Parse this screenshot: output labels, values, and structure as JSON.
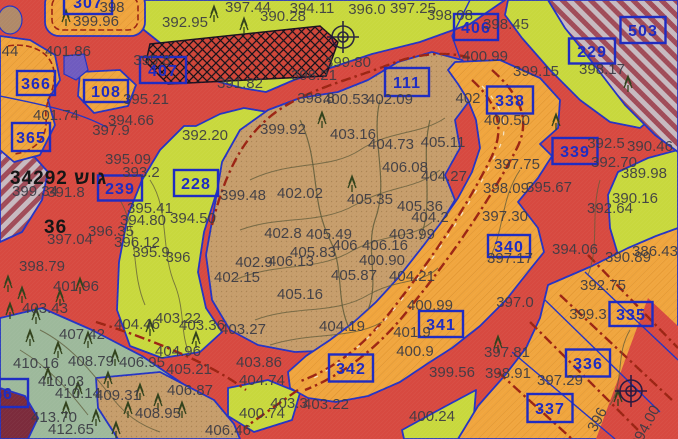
{
  "map": {
    "title_block": {
      "label": "34292 גוש",
      "secondary": "36"
    },
    "parcel_boxes": [
      {
        "n": "307",
        "x": 88,
        "y": 2,
        "w": 48,
        "h": 24
      },
      {
        "n": "406",
        "x": 476,
        "y": 27,
        "w": 44,
        "h": 26
      },
      {
        "n": "503",
        "x": 643,
        "y": 30,
        "w": 45,
        "h": 26
      },
      {
        "n": "229",
        "x": 592,
        "y": 51,
        "w": 46,
        "h": 25
      },
      {
        "n": "407",
        "x": 163,
        "y": 70,
        "w": 46,
        "h": 26
      },
      {
        "n": "111",
        "x": 407,
        "y": 82,
        "w": 44,
        "h": 28
      },
      {
        "n": "338",
        "x": 510,
        "y": 100,
        "w": 46,
        "h": 27
      },
      {
        "n": "366",
        "x": 36,
        "y": 83,
        "w": 38,
        "h": 24
      },
      {
        "n": "108",
        "x": 106,
        "y": 91,
        "w": 44,
        "h": 22
      },
      {
        "n": "365",
        "x": 31,
        "y": 137,
        "w": 38,
        "h": 28
      },
      {
        "n": "239",
        "x": 120,
        "y": 188,
        "w": 44,
        "h": 25
      },
      {
        "n": "228",
        "x": 196,
        "y": 183,
        "w": 44,
        "h": 26
      },
      {
        "n": "339",
        "x": 575,
        "y": 151,
        "w": 45,
        "h": 26
      },
      {
        "n": "340",
        "x": 509,
        "y": 246,
        "w": 42,
        "h": 22
      },
      {
        "n": "341",
        "x": 441,
        "y": 324,
        "w": 44,
        "h": 26
      },
      {
        "n": "342",
        "x": 351,
        "y": 368,
        "w": 44,
        "h": 27
      },
      {
        "n": "335",
        "x": 631,
        "y": 314,
        "w": 43,
        "h": 24
      },
      {
        "n": "336",
        "x": 588,
        "y": 363,
        "w": 44,
        "h": 27
      },
      {
        "n": "337",
        "x": 550,
        "y": 408,
        "w": 45,
        "h": 28
      },
      {
        "n": "56",
        "x": 3,
        "y": 393,
        "w": 50,
        "h": 28
      }
    ],
    "elevation_labels": [
      {
        "t": "398",
        "x": 112,
        "y": 8
      },
      {
        "t": "399.96",
        "x": 96,
        "y": 22
      },
      {
        "t": "392.95",
        "x": 185,
        "y": 23
      },
      {
        "t": "397.44",
        "x": 248,
        "y": 8
      },
      {
        "t": "390.28",
        "x": 283,
        "y": 17
      },
      {
        "t": "394.11",
        "x": 312,
        "y": 9
      },
      {
        "t": "396.0",
        "x": 367,
        "y": 10
      },
      {
        "t": "397.25",
        "x": 413,
        "y": 9
      },
      {
        "t": "398.08",
        "x": 450,
        "y": 16
      },
      {
        "t": "398.45",
        "x": 506,
        "y": 25
      },
      {
        "t": "400.99",
        "x": 485,
        "y": 57
      },
      {
        "t": "399.15",
        "x": 536,
        "y": 72
      },
      {
        "t": "398.17",
        "x": 602,
        "y": 70
      },
      {
        "t": "392.5",
        "x": 606,
        "y": 144
      },
      {
        "t": "390.46",
        "x": 650,
        "y": 147
      },
      {
        "t": "392.70",
        "x": 614,
        "y": 163
      },
      {
        "t": "389.98",
        "x": 644,
        "y": 174
      },
      {
        "t": "390.16",
        "x": 635,
        "y": 199
      },
      {
        "t": "392.64",
        "x": 610,
        "y": 209
      },
      {
        "t": "386.43",
        "x": 655,
        "y": 252
      },
      {
        "t": "394.06",
        "x": 575,
        "y": 250
      },
      {
        "t": "390.89",
        "x": 628,
        "y": 258
      },
      {
        "t": "44",
        "x": 10,
        "y": 52
      },
      {
        "t": "401.86",
        "x": 68,
        "y": 52
      },
      {
        "t": "395.8",
        "x": 152,
        "y": 61
      },
      {
        "t": "395.21",
        "x": 146,
        "y": 100
      },
      {
        "t": "394.66",
        "x": 131,
        "y": 121
      },
      {
        "t": "397.9",
        "x": 111,
        "y": 131
      },
      {
        "t": "392.20",
        "x": 205,
        "y": 136
      },
      {
        "t": "401.74",
        "x": 56,
        "y": 116
      },
      {
        "t": "391.82",
        "x": 240,
        "y": 84
      },
      {
        "t": "398.21",
        "x": 314,
        "y": 76
      },
      {
        "t": "399.80",
        "x": 348,
        "y": 63
      },
      {
        "t": "398.8",
        "x": 316,
        "y": 99
      },
      {
        "t": "400.53",
        "x": 346,
        "y": 100
      },
      {
        "t": "402.09",
        "x": 390,
        "y": 100
      },
      {
        "t": "399.92",
        "x": 283,
        "y": 130
      },
      {
        "t": "403.16",
        "x": 353,
        "y": 135
      },
      {
        "t": "404.73",
        "x": 391,
        "y": 145
      },
      {
        "t": "405.11",
        "x": 443,
        "y": 143
      },
      {
        "t": "406.08",
        "x": 405,
        "y": 168
      },
      {
        "t": "404.27",
        "x": 444,
        "y": 177
      },
      {
        "t": "405.36",
        "x": 420,
        "y": 207
      },
      {
        "t": "404.2",
        "x": 430,
        "y": 218
      },
      {
        "t": "399.48",
        "x": 243,
        "y": 196
      },
      {
        "t": "402.02",
        "x": 300,
        "y": 194
      },
      {
        "t": "405.35",
        "x": 370,
        "y": 200
      },
      {
        "t": "402.8",
        "x": 283,
        "y": 234
      },
      {
        "t": "405.49",
        "x": 329,
        "y": 235
      },
      {
        "t": "403.99",
        "x": 412,
        "y": 235
      },
      {
        "t": "406",
        "x": 345,
        "y": 246
      },
      {
        "t": "406.16",
        "x": 385,
        "y": 246
      },
      {
        "t": "405.83",
        "x": 313,
        "y": 253
      },
      {
        "t": "400.90",
        "x": 382,
        "y": 261
      },
      {
        "t": "402.9",
        "x": 254,
        "y": 263
      },
      {
        "t": "406.13",
        "x": 291,
        "y": 262
      },
      {
        "t": "402.15",
        "x": 237,
        "y": 278
      },
      {
        "t": "405.87",
        "x": 354,
        "y": 276
      },
      {
        "t": "404.21",
        "x": 412,
        "y": 277
      },
      {
        "t": "405.16",
        "x": 300,
        "y": 295
      },
      {
        "t": "404.19",
        "x": 342,
        "y": 327
      },
      {
        "t": "403.27",
        "x": 243,
        "y": 330
      },
      {
        "t": "399.34",
        "x": 35,
        "y": 192
      },
      {
        "t": "391.8",
        "x": 66,
        "y": 193
      },
      {
        "t": "395.09",
        "x": 128,
        "y": 160
      },
      {
        "t": "393.2",
        "x": 141,
        "y": 173
      },
      {
        "t": "395.41",
        "x": 150,
        "y": 209
      },
      {
        "t": "394.80",
        "x": 143,
        "y": 221
      },
      {
        "t": "394.50",
        "x": 193,
        "y": 219
      },
      {
        "t": "396.35",
        "x": 111,
        "y": 232
      },
      {
        "t": "397.04",
        "x": 70,
        "y": 240
      },
      {
        "t": "396.12",
        "x": 137,
        "y": 243
      },
      {
        "t": "395.9",
        "x": 151,
        "y": 253
      },
      {
        "t": "396",
        "x": 178,
        "y": 258
      },
      {
        "t": "398.79",
        "x": 42,
        "y": 267
      },
      {
        "t": "401.96",
        "x": 76,
        "y": 287
      },
      {
        "t": "403.43",
        "x": 45,
        "y": 309
      },
      {
        "t": "407.42",
        "x": 82,
        "y": 335
      },
      {
        "t": "404.46",
        "x": 137,
        "y": 325
      },
      {
        "t": "403.22",
        "x": 178,
        "y": 319
      },
      {
        "t": "403.36",
        "x": 202,
        "y": 326
      },
      {
        "t": "404.96",
        "x": 178,
        "y": 352
      },
      {
        "t": "408.79",
        "x": 91,
        "y": 362
      },
      {
        "t": "406.95",
        "x": 142,
        "y": 363
      },
      {
        "t": "405.21",
        "x": 189,
        "y": 370
      },
      {
        "t": "410.16",
        "x": 36,
        "y": 364
      },
      {
        "t": "410.03",
        "x": 61,
        "y": 382
      },
      {
        "t": "410.14",
        "x": 78,
        "y": 394
      },
      {
        "t": "409.31",
        "x": 118,
        "y": 396
      },
      {
        "t": "413.70",
        "x": 54,
        "y": 418
      },
      {
        "t": "412.65",
        "x": 71,
        "y": 430
      },
      {
        "t": "406.87",
        "x": 190,
        "y": 391
      },
      {
        "t": "408.95",
        "x": 158,
        "y": 414
      },
      {
        "t": "403.86",
        "x": 259,
        "y": 363
      },
      {
        "t": "404.74",
        "x": 262,
        "y": 381
      },
      {
        "t": "403.3",
        "x": 289,
        "y": 404
      },
      {
        "t": "403.22",
        "x": 326,
        "y": 405
      },
      {
        "t": "400.74",
        "x": 262,
        "y": 414
      },
      {
        "t": "406.46",
        "x": 228,
        "y": 431
      },
      {
        "t": "400.24",
        "x": 432,
        "y": 417
      },
      {
        "t": "399.56",
        "x": 452,
        "y": 373
      },
      {
        "t": "398.91",
        "x": 508,
        "y": 374
      },
      {
        "t": "397.29",
        "x": 560,
        "y": 381
      },
      {
        "t": "397.81",
        "x": 507,
        "y": 353
      },
      {
        "t": "397.0",
        "x": 515,
        "y": 303
      },
      {
        "t": "397.17",
        "x": 510,
        "y": 259
      },
      {
        "t": "400.99",
        "x": 430,
        "y": 306
      },
      {
        "t": "401.9",
        "x": 412,
        "y": 333
      },
      {
        "t": "400.9",
        "x": 415,
        "y": 352
      },
      {
        "t": "397.75",
        "x": 517,
        "y": 165
      },
      {
        "t": "398.09",
        "x": 506,
        "y": 189
      },
      {
        "t": "395.67",
        "x": 549,
        "y": 188
      },
      {
        "t": "397.30",
        "x": 505,
        "y": 217
      },
      {
        "t": "400.50",
        "x": 507,
        "y": 121
      },
      {
        "t": "402",
        "x": 468,
        "y": 99
      },
      {
        "t": "392.75",
        "x": 603,
        "y": 286
      },
      {
        "t": "399.3",
        "x": 588,
        "y": 315
      },
      {
        "t": "394.00",
        "x": 646,
        "y": 427,
        "r": -62
      },
      {
        "t": "396",
        "x": 598,
        "y": 420,
        "r": -62
      }
    ],
    "survey_markers": [
      {
        "x": 343,
        "y": 37
      },
      {
        "x": 631,
        "y": 391
      }
    ],
    "trees": [
      [
        8,
        286
      ],
      [
        22,
        297
      ],
      [
        10,
        313
      ],
      [
        36,
        318
      ],
      [
        60,
        300
      ],
      [
        80,
        288
      ],
      [
        30,
        340
      ],
      [
        58,
        352
      ],
      [
        88,
        342
      ],
      [
        115,
        360
      ],
      [
        48,
        378
      ],
      [
        78,
        392
      ],
      [
        108,
        382
      ],
      [
        140,
        394
      ],
      [
        66,
        412
      ],
      [
        96,
        420
      ],
      [
        128,
        412
      ],
      [
        158,
        404
      ],
      [
        182,
        412
      ],
      [
        116,
        432
      ],
      [
        150,
        330
      ],
      [
        196,
        342
      ],
      [
        214,
        16
      ],
      [
        244,
        28
      ],
      [
        66,
        20
      ],
      [
        322,
        122
      ],
      [
        352,
        186
      ],
      [
        556,
        124
      ],
      [
        628,
        86
      ],
      [
        498,
        346
      ],
      [
        618,
        400
      ]
    ],
    "palette": {
      "red": "#d74940",
      "hatchred": "#cf4538",
      "chartreuse": "#c8d83d",
      "tan": "#c69d6b",
      "orange": "#f0a53e",
      "sage": "#9db99b",
      "blue": "#2433c4",
      "boxblue": "#1f2cc2",
      "roadred": "#9b2413",
      "stripeA": "#a04b58",
      "stripeB": "#c7bac0",
      "maroon": "#7c2b3c",
      "purple": "#6f5bbf",
      "brown": "#b08968",
      "contour": "#5e5a38",
      "label": "#3b3b45",
      "black": "#161616",
      "hatchline": "#17121a"
    }
  }
}
